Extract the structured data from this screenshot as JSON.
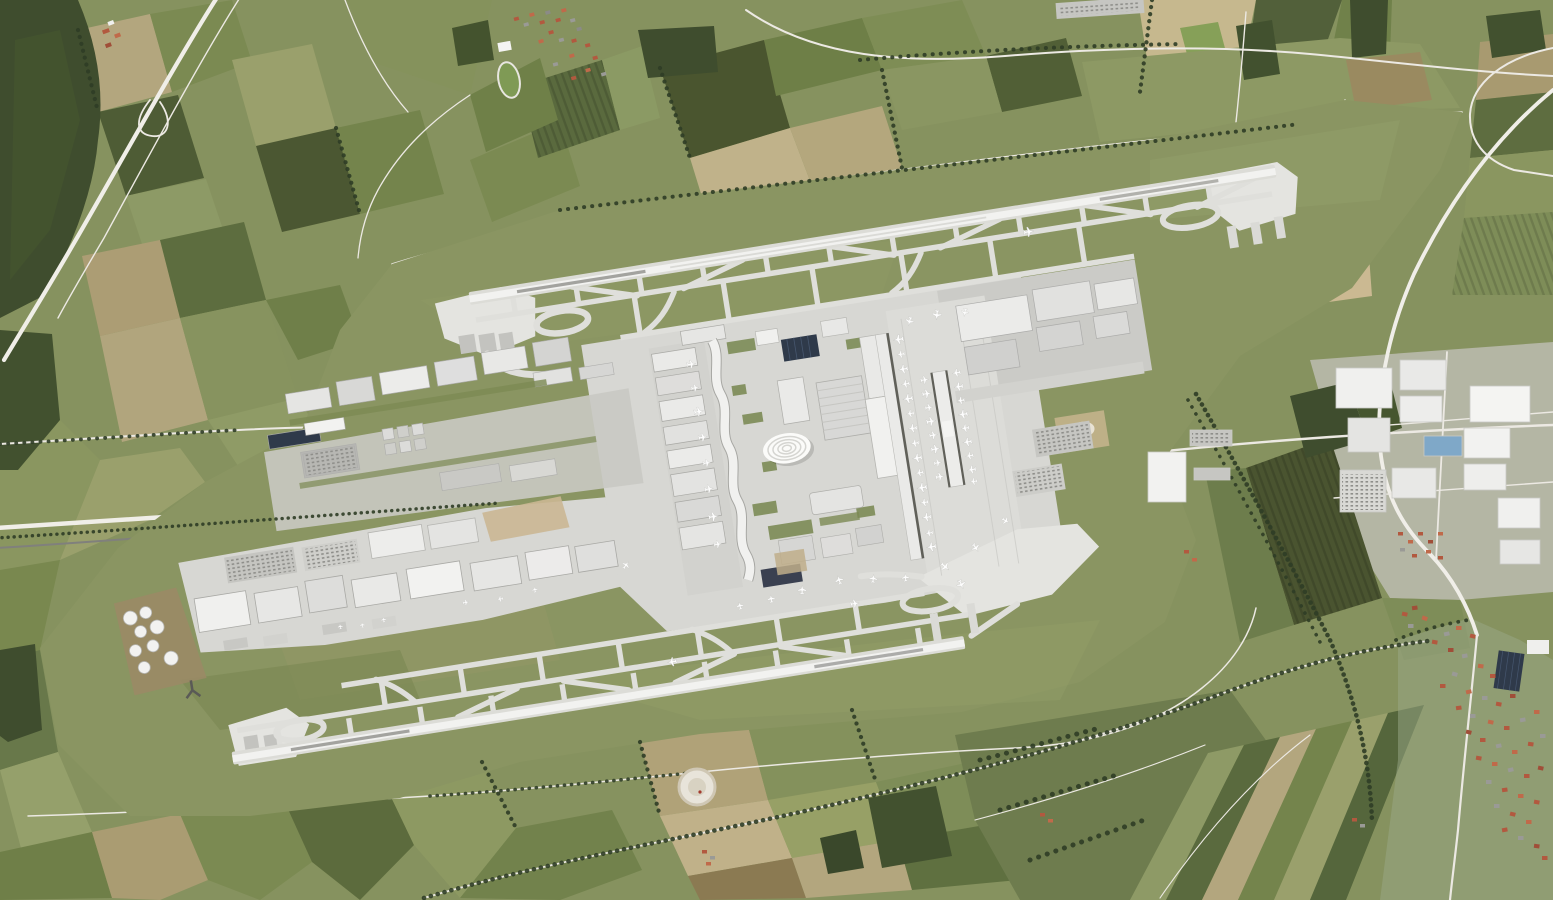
{
  "scene": {
    "title": "Satellite aerial photograph of a large international airport with two parallel runways",
    "caption": "Orthophoto: Munich-style international airport seen from directly above. Two long parallel runways run diagonally (west-southwest to east-northeast), each with parallel taxiways, braided high-speed exits and holding pads at both ends. A central campus holds Terminal 1 with a wavy pier, a tent-roofed forum building, Terminal 2 with a gate pier and a satellite concourse lined with parked aircraft, cargo warehouses, hangars, a fuel tank farm and car parks. The airfield grass band is surrounded by a patchwork of farm fields, forests, country roads with tree rows, villages with red roofs, an industrial park with white warehouses, a gravel pit, and a moorland with scattered trees.",
    "landmarks": {
      "north_runway": "runway with parallel taxiway and crossing exit taxiways, upper half",
      "south_runway": "offset runway with parallel taxiways, lower half",
      "terminal_1": "west terminal with wavy pier and module buildings",
      "terminal_2": "east terminal with gate pier and apron",
      "satellite_concourse": "midfield satellite flanked by aircraft",
      "forum_tent_roof": "white ribbed tent-roof building in campus center",
      "fuel_farm": "white circular tanks on brown ground, west side",
      "gravel_pit": "white circular pit in fields, bottom center",
      "villages": "red-roofed villages top-left-of-center and bottom-right",
      "industrial_park": "white warehouses on right edge"
    },
    "aircraft_visible": 52
  },
  "palette": {
    "base_field_green": "#86925f",
    "airfield_grass": "#8a9562",
    "runway": "#f2f2f0",
    "runway_shoulder": "#dcdcd7",
    "taxiway": "#dfdfdb",
    "apron": "#d7d7d3",
    "apron_secondary": "#cbcbc7",
    "holding_pad": "#e4e4e0",
    "building_white": "#f0f0ee",
    "building_gray": "#c6c6c2",
    "solar_roof": "#2f3a4a",
    "tent_roof": "#fbfbf9",
    "forest": "#3f4d2e",
    "tree_line": "#2f3d26",
    "road": "#ece9e3",
    "highway": "#f0eee8",
    "rail": "#80807c",
    "aircraft": "#fdfdfd",
    "roof_red": "#b2593f",
    "roof_gray": "#9a9a96",
    "field_tan": "#b3a67e",
    "field_dark": "#4a552f",
    "blue_roof": "#7fa8c8",
    "gravel": "#e8e4da"
  }
}
